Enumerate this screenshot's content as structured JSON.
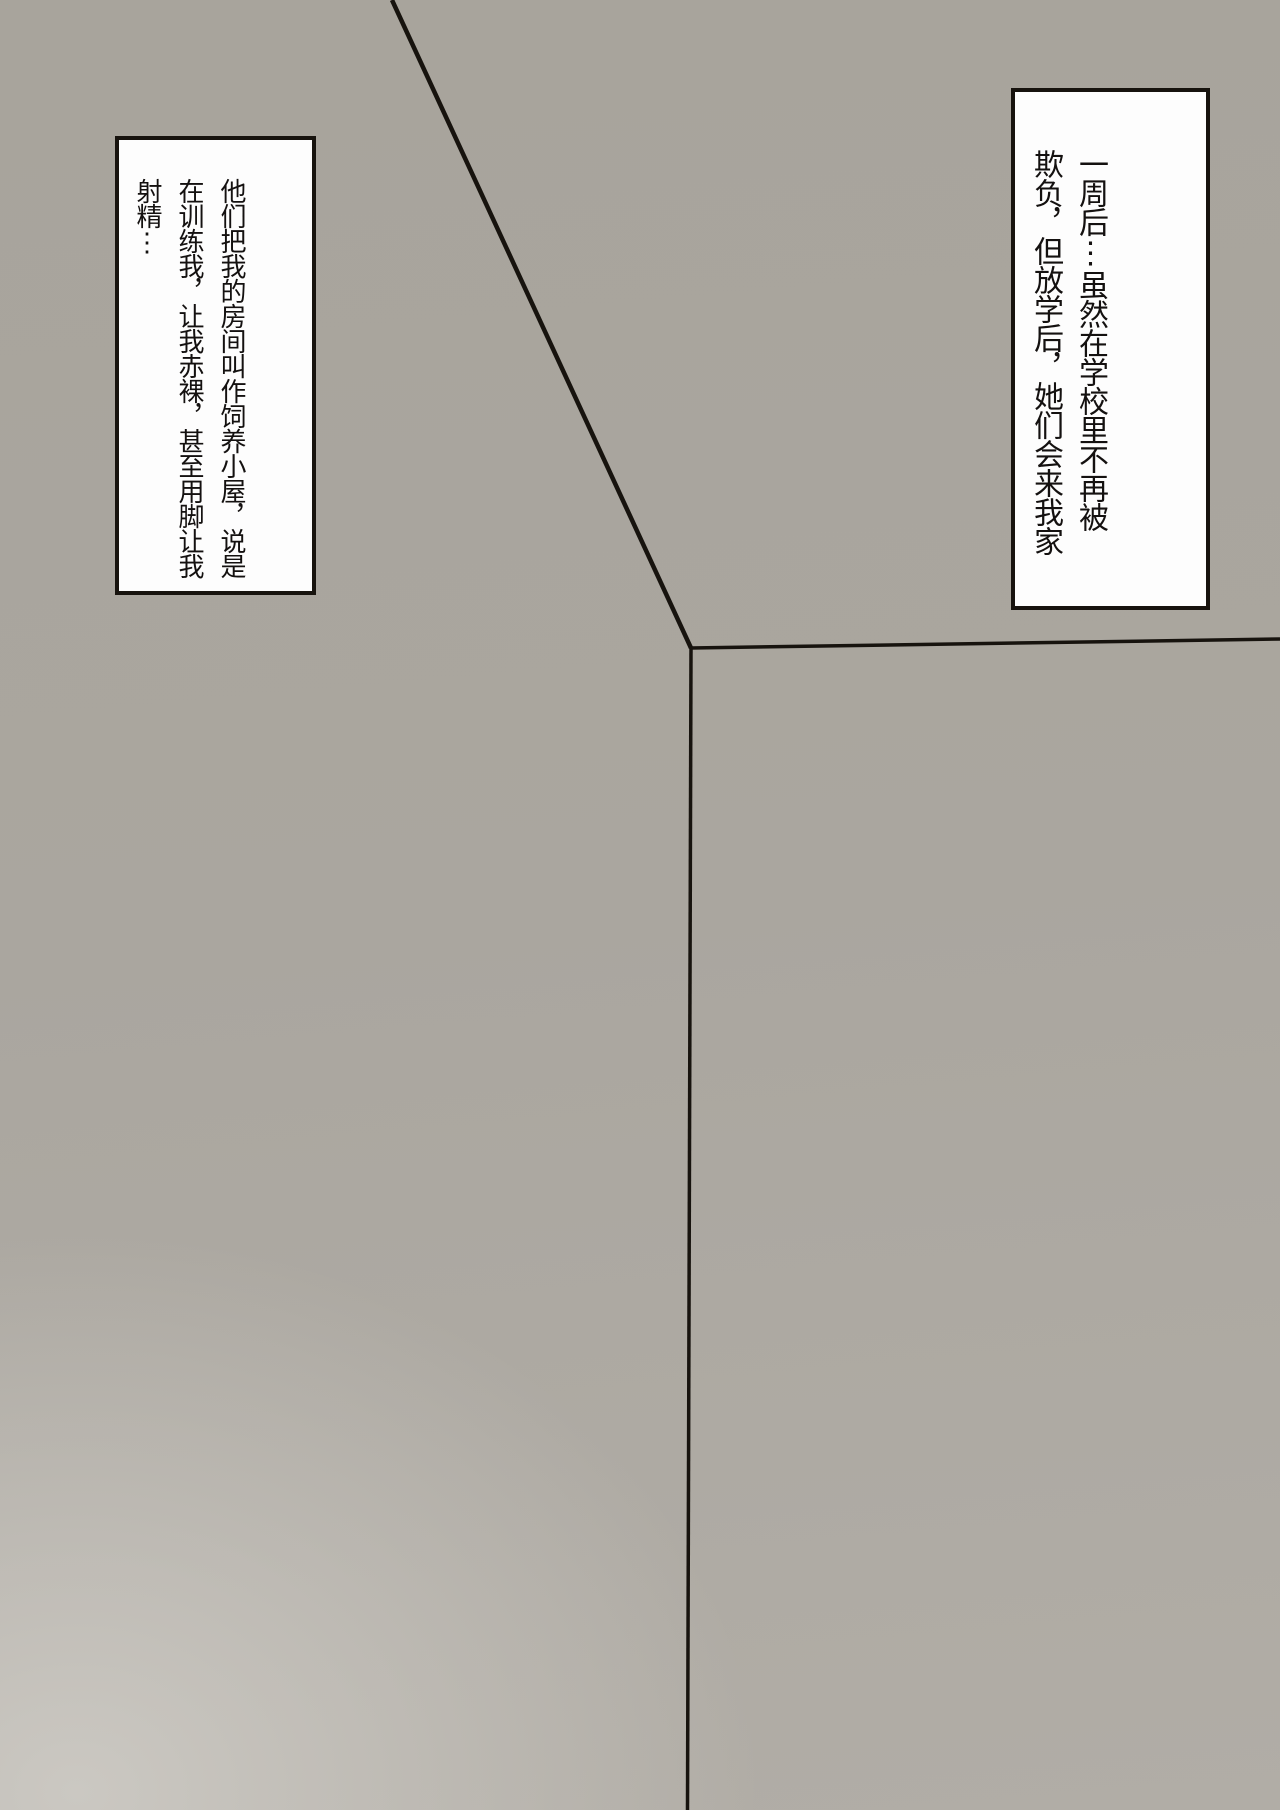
{
  "theme": {
    "background_top": "#a8a49c",
    "background_bottom": "#b1ada6",
    "background_glow": "#cbc8c2",
    "line": "#17130e",
    "panel_border": "#17130e",
    "panel_bg": "#fdfdfd",
    "text": "#141110"
  },
  "narration_boxes": {
    "right": {
      "text": "一周后⋮虽然在学校里不再被\n欺负，但放学后，她们会来我家"
    },
    "left": {
      "text": "他们把我的房间叫作饲养小屋，说是\n在训练我，让我赤裸，甚至用脚让我\n射精⋮"
    }
  }
}
